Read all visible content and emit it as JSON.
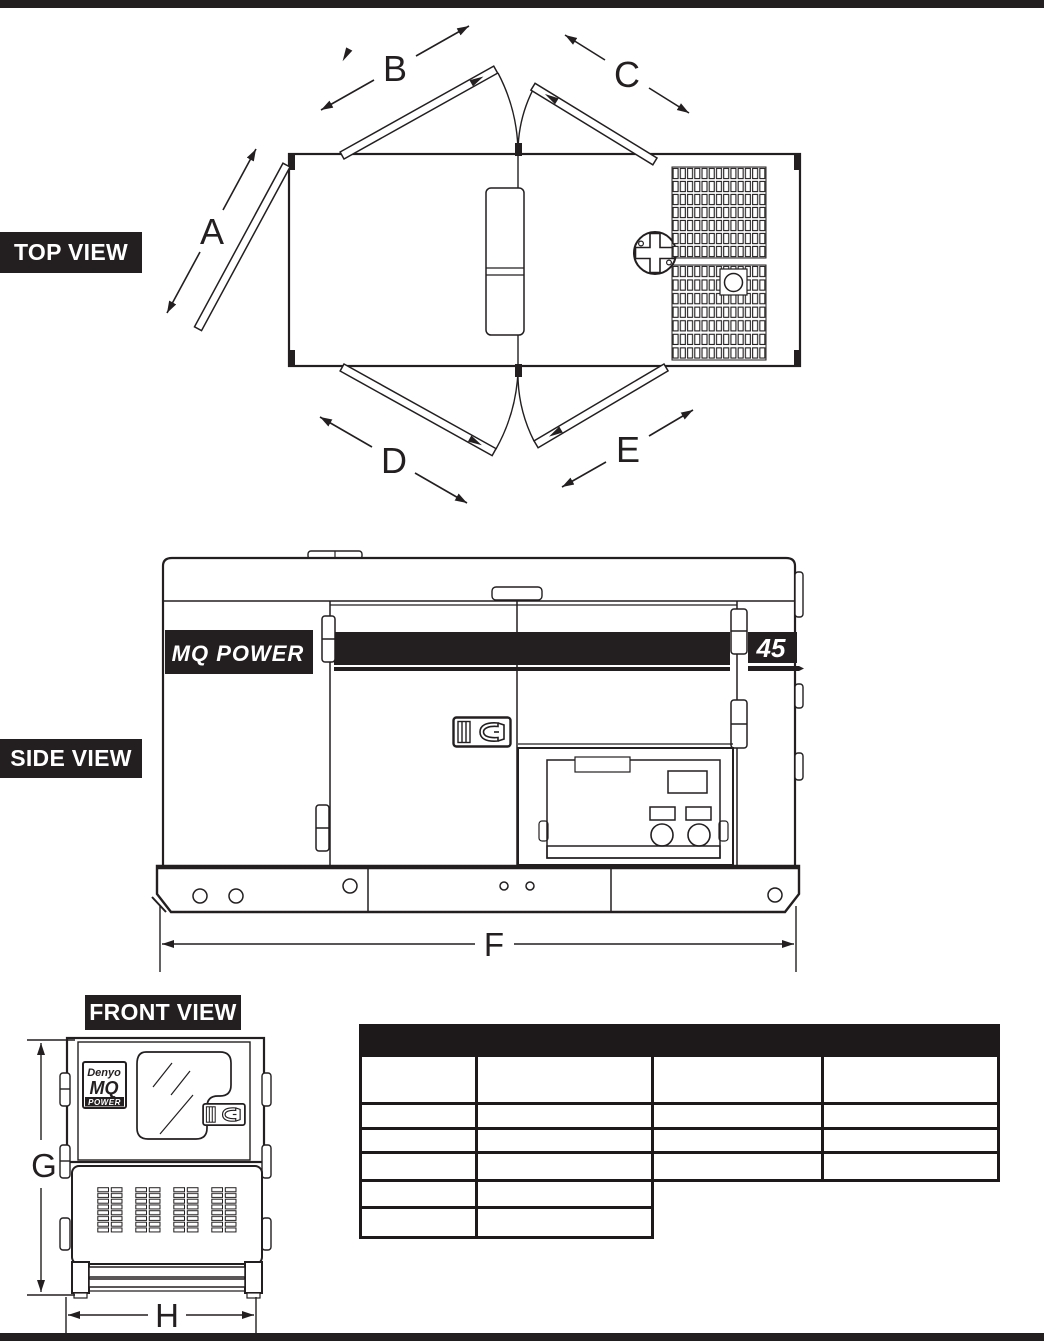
{
  "labels": {
    "top_view": "TOP VIEW",
    "side_view": "SIDE VIEW",
    "front_view": "FRONT VIEW"
  },
  "dims": {
    "a": "A",
    "b": "B",
    "c": "C",
    "d": "D",
    "e": "E",
    "f": "F",
    "g": "G",
    "h": "H"
  },
  "branding": {
    "mq_power_logo": "MQ POWER",
    "model_number": "45",
    "badge_brand": "Denyo",
    "badge_mq": "MQ",
    "badge_power": "POWER"
  },
  "table": {
    "header_label": "",
    "columns": 4,
    "full_rows": 4,
    "partial_rows": 2
  },
  "colors": {
    "ink": "#231f20",
    "table_border": "#1d191a",
    "background": "#ffffff"
  }
}
